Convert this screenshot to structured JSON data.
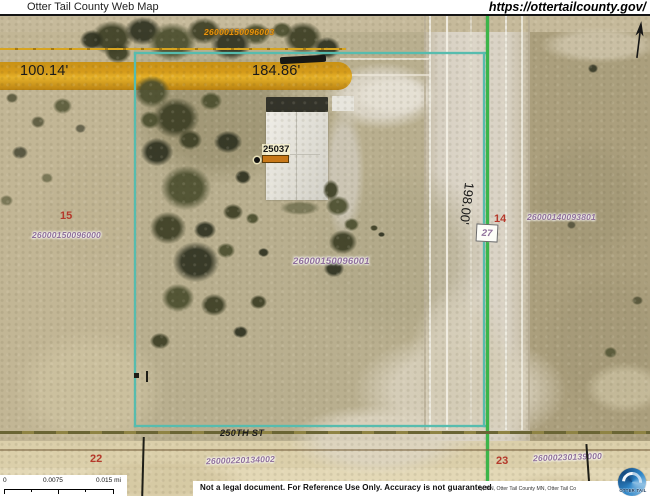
{
  "header": {
    "title": "Otter Tail County Web Map",
    "url": "https://ottertailcounty.gov/"
  },
  "map": {
    "highlighted_parcel_id": "26000150096003",
    "center_parcel_id": "26000150096001",
    "measurements": {
      "west": "100.14'",
      "north": "184.86'",
      "east": "198.00'"
    },
    "house_number": "25037",
    "lot_number": "27",
    "street": "250TH ST",
    "sections": [
      {
        "number": "15",
        "parcel_id": "26000150096000"
      },
      {
        "number": "14",
        "parcel_id": "26000140093801"
      },
      {
        "number": "22",
        "parcel_id": "26000220134002"
      },
      {
        "number": "23",
        "parcel_id": "26000230139000"
      }
    ]
  },
  "scalebar": {
    "start": "0",
    "middle": "0.0075",
    "end": "0.015 mi"
  },
  "footer": {
    "disclaimer": "Not a legal document. For Reference Use Only.  Accuracy is not guaranteed",
    "attribution": "ty, MN, Otter Tail County MN, Otter Tail Co",
    "logo_text": "OTTER TAIL"
  },
  "colors": {
    "parcel_boundary": "#57bcae",
    "section_line_green": "#3cb54a",
    "lot_line_yellow": "#d8a520",
    "highlight_band": "#d69a14",
    "parcel_label": "#8f6f9a",
    "section_number": "#b5392b",
    "highlighted_label": "#e89410"
  }
}
